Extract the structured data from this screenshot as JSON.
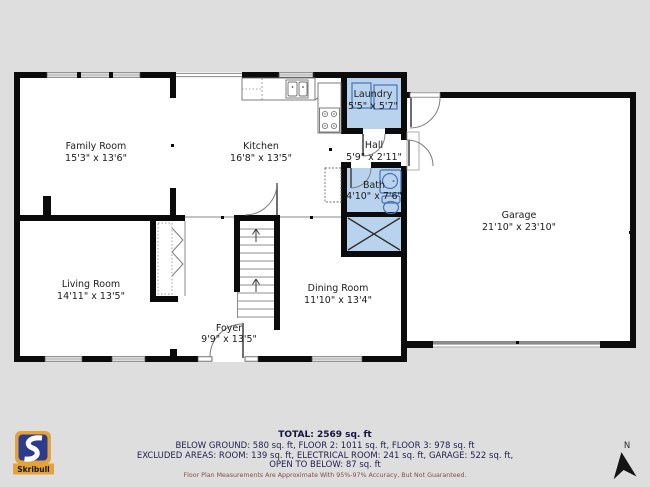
{
  "rooms": [
    {
      "name": "Family Room",
      "dims": "15'3\" x 13'6\""
    },
    {
      "name": "Kitchen",
      "dims": "16'8\" x 13'5\""
    },
    {
      "name": "Laundry",
      "dims": "5'5\" x 5'7\"",
      "highlight": "#b9d3ee"
    },
    {
      "name": "Hall",
      "dims": "5'9\" x 2'11\""
    },
    {
      "name": "Bath",
      "dims": "4'10\" x 7'6\"",
      "highlight": "#b9d3ee"
    },
    {
      "name": "Garage",
      "dims": "21'10\" x 23'10\""
    },
    {
      "name": "Living Room",
      "dims": "14'11\" x 13'5\""
    },
    {
      "name": "Dining Room",
      "dims": "11'10\" x 13'4\""
    },
    {
      "name": "Foyer",
      "dims": "9'9\" x 13'5\""
    }
  ],
  "footer": {
    "total": "TOTAL: 2569 sq. ft",
    "line1": "BELOW GROUND: 580 sq. ft, FLOOR 2: 1011 sq. ft, FLOOR 3: 978 sq. ft",
    "line2": "EXCLUDED AREAS: ROOM: 139 sq. ft, ELECTRICAL ROOM: 241 sq. ft, GARAGE: 522 sq. ft,",
    "line3": "OPEN TO BELOW: 87 sq. ft",
    "disclaimer": "Floor Plan Measurements Are Approximate With 95%-97% Accuracy, But Not Guaranteed."
  },
  "logo": {
    "brand": "Skribull"
  },
  "compass": {
    "label": "N"
  },
  "colors": {
    "background": "#dedede",
    "wall": "#0b0b0b",
    "highlight_room": "#b9d3ee",
    "fixture_blue": "#4a72ae",
    "logo_orange": "#e2a23c",
    "logo_navy": "#2e3a8c",
    "footer_text": "#1e1e50",
    "disclaimer_text": "#7e5146"
  }
}
